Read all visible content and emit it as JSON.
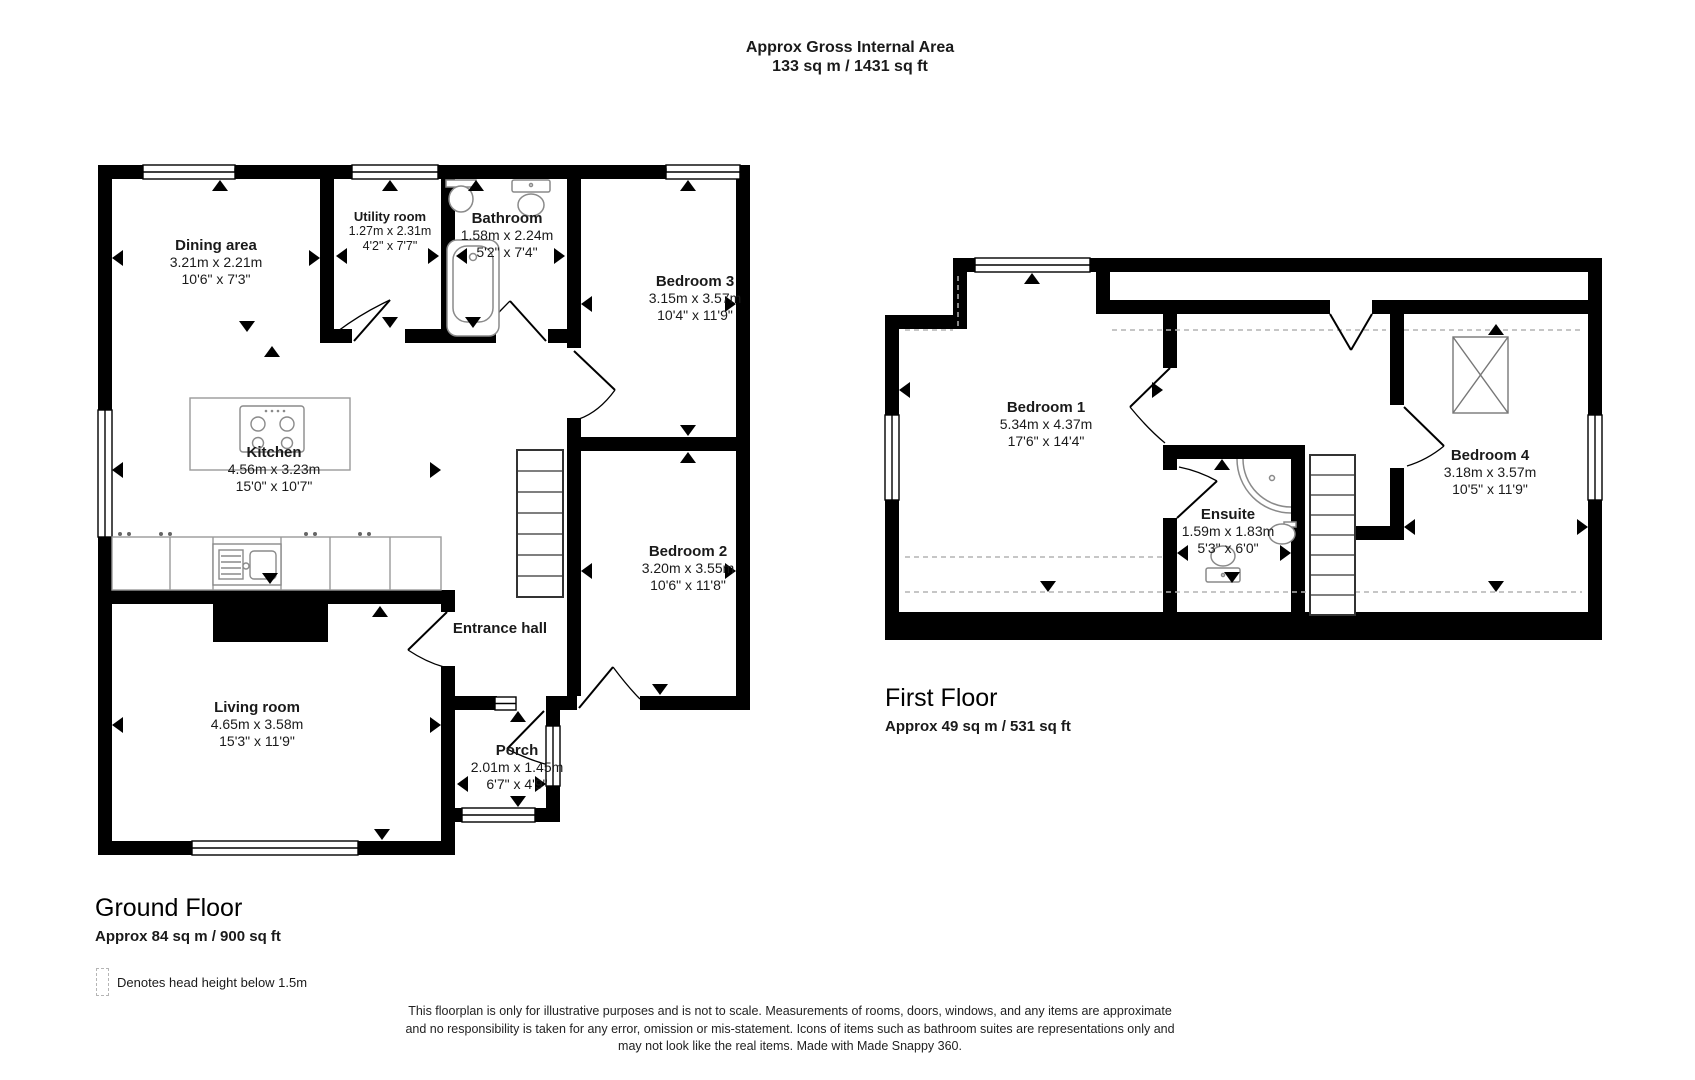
{
  "title": {
    "line1": "Approx Gross Internal Area",
    "line2": "133 sq m / 1431 sq ft"
  },
  "ground_floor": {
    "name": "Ground Floor",
    "area": "Approx 84 sq m / 900 sq ft",
    "rooms": [
      {
        "name": "Dining area",
        "metric": "3.21m x 2.21m",
        "imperial": "10'6\" x 7'3\""
      },
      {
        "name": "Utility room",
        "metric": "1.27m x 2.31m",
        "imperial": "4'2\" x 7'7\""
      },
      {
        "name": "Bathroom",
        "metric": "1.58m x 2.24m",
        "imperial": "5'2\" x 7'4\""
      },
      {
        "name": "Bedroom 3",
        "metric": "3.15m x 3.57m",
        "imperial": "10'4\" x 11'9\""
      },
      {
        "name": "Kitchen",
        "metric": "4.56m x 3.23m",
        "imperial": "15'0\" x 10'7\""
      },
      {
        "name": "Bedroom 2",
        "metric": "3.20m x 3.55m",
        "imperial": "10'6\" x 11'8\""
      },
      {
        "name": "Entrance hall"
      },
      {
        "name": "Living room",
        "metric": "4.65m x 3.58m",
        "imperial": "15'3\" x 11'9\""
      },
      {
        "name": "Porch",
        "metric": "2.01m x 1.45m",
        "imperial": "6'7\" x 4'9\""
      }
    ]
  },
  "first_floor": {
    "name": "First Floor",
    "area": "Approx 49 sq m / 531 sq ft",
    "rooms": [
      {
        "name": "Bedroom 1",
        "metric": "5.34m x 4.37m",
        "imperial": "17'6\" x 14'4\""
      },
      {
        "name": "Ensuite",
        "metric": "1.59m x 1.83m",
        "imperial": "5'3\" x 6'0\""
      },
      {
        "name": "Bedroom 4",
        "metric": "3.18m x 3.57m",
        "imperial": "10'5\" x 11'9\""
      }
    ]
  },
  "legend": {
    "text": "Denotes head height below 1.5m"
  },
  "disclaimer": {
    "line1": "This floorplan is only for illustrative purposes and is not to scale. Measurements of rooms, doors, windows, and any items are approximate",
    "line2": "and no responsibility is taken for any error, omission or mis-statement. Icons of items such as bathroom suites are representations only and",
    "line3": "may not look like the real items. Made with Made Snappy 360."
  },
  "colors": {
    "wall": "#000000",
    "background": "#ffffff",
    "fixture": "#8a8a8a",
    "head_height_dash": "#b3b3b3"
  }
}
